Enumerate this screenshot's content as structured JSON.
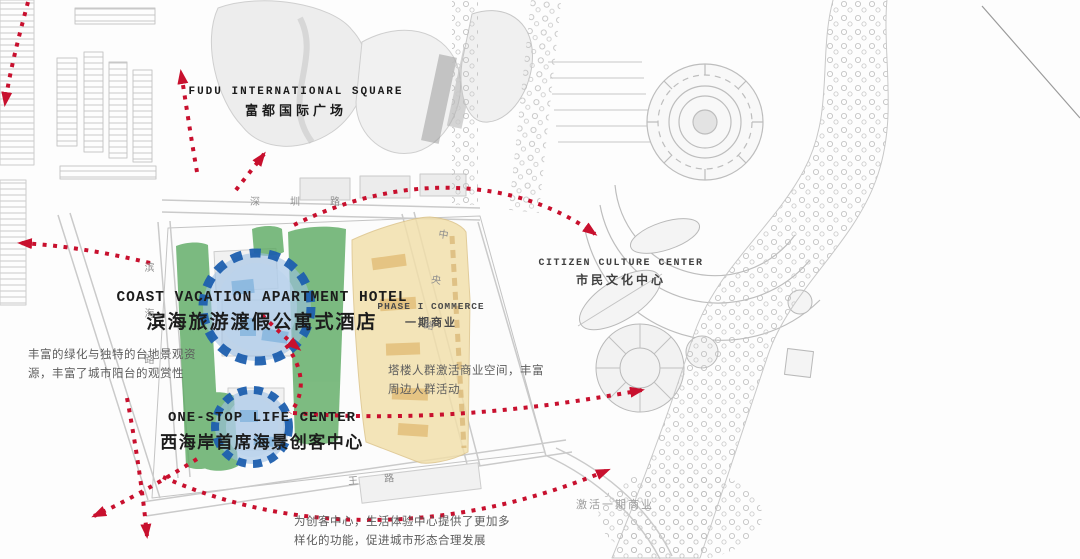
{
  "labels": {
    "fudu": {
      "en": "FUDU INTERNATIONAL SQUARE",
      "zh": "富都国际广场"
    },
    "coast": {
      "en": "COAST VACATION APARTMENT HOTEL",
      "zh": "滨海旅游渡假公寓式酒店"
    },
    "onestop": {
      "en": "ONE-STOP LIFE CENTER",
      "zh": "西海岸首席海景创客中心"
    },
    "citizen": {
      "en": "CITIZEN CULTURE CENTER",
      "zh": "市民文化中心"
    },
    "phase1": {
      "en": "PHASE I COMMERCE",
      "zh": "一期商业"
    }
  },
  "notes": {
    "terrace_line1": "丰富的绿化与独特的台地景观资",
    "terrace_line2": "源，丰富了城市阳台的观赏性",
    "tower_line1": "塔楼人群激活商业空间，丰富",
    "tower_line2": "周边人群活动",
    "maker_line1": "为创客中心，生活体验中心提供了更加多",
    "maker_line2": "样化的功能，促进城市形态合理发展",
    "activate": "激活一期商业"
  },
  "roads": {
    "shenzhen": "深圳路",
    "binhai": "滨海路",
    "zhongyang": "中央路",
    "wang": "王路"
  },
  "colors": {
    "arrow_red": "#c8102e",
    "zone_green": "#58a85e",
    "zone_yellow": "#f2dfaa",
    "node_blue_fill": "#9cc0e4",
    "node_blue_ring": "#1d5fae"
  }
}
